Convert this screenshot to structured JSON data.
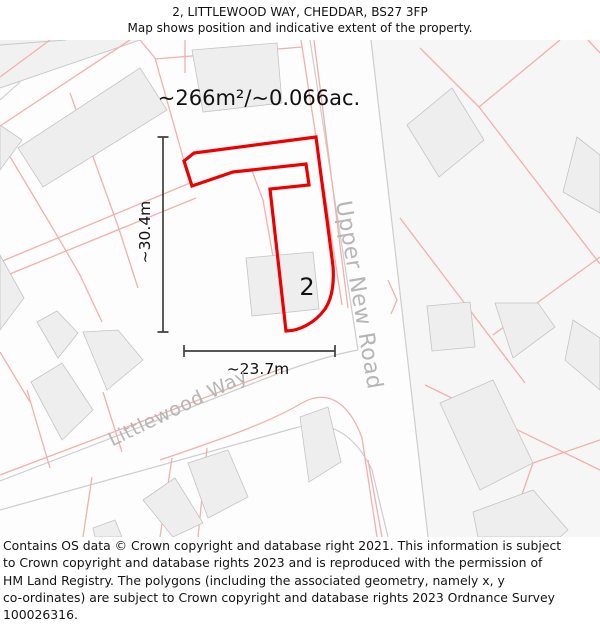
{
  "header": {
    "title": "2, LITTLEWOOD WAY, CHEDDAR, BS27 3FP",
    "subtitle": "Map shows position and indicative extent of the property."
  },
  "map": {
    "area_label": "~266m²/~0.066ac.",
    "width_label": "~23.7m",
    "height_label": "~30.4m",
    "plot_number": "2",
    "roads": [
      {
        "name": "Upper New Road"
      },
      {
        "name": "Littlewood Way"
      }
    ],
    "colors": {
      "red": "#ee0000",
      "pink": "#f2b0ac",
      "roadgray": "#cdcdcd",
      "bld_fill": "#efeeee",
      "bld_stroke": "#c4c4c4",
      "measure": "#3f3f3f",
      "roadlabel": "#b8b5b5",
      "parcel_tint": "#f7f6f6"
    }
  },
  "footer": {
    "lines": [
      "Contains OS data © Crown copyright and database right 2021. This information is subject",
      "to Crown copyright and database rights 2023 and is reproduced with the permission of",
      "HM Land Registry. The polygons (including the associated geometry, namely x, y",
      "co-ordinates) are subject to Crown copyright and database rights 2023 Ordnance Survey",
      "100026316."
    ]
  }
}
